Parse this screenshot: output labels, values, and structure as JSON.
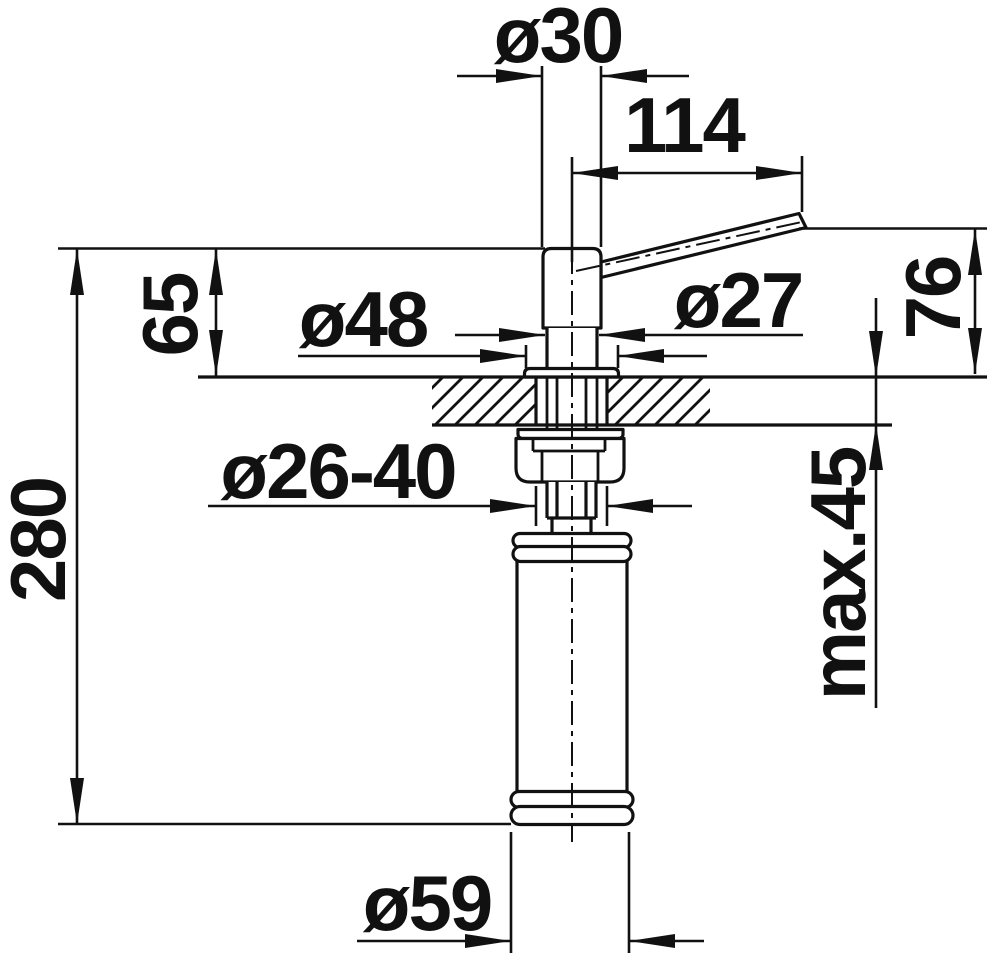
{
  "drawing": {
    "kind": "technical-dimension-drawing",
    "subject": "kitchen soap dispenser, side section view with mounting countertop",
    "colors": {
      "background": "#ffffff",
      "line": "#111111",
      "text": "#111111"
    },
    "dimensions": {
      "spout_tube_diameter": "ø30",
      "spout_reach": "114",
      "head_height_above_counter": "65",
      "flange_diameter": "ø48",
      "neck_diameter": "ø27",
      "spout_outlet_height": "76",
      "overall_height": "280",
      "mounting_hole_diameter": "ø26-40",
      "max_counter_thickness": "max.45",
      "bottle_diameter": "ø59"
    }
  }
}
